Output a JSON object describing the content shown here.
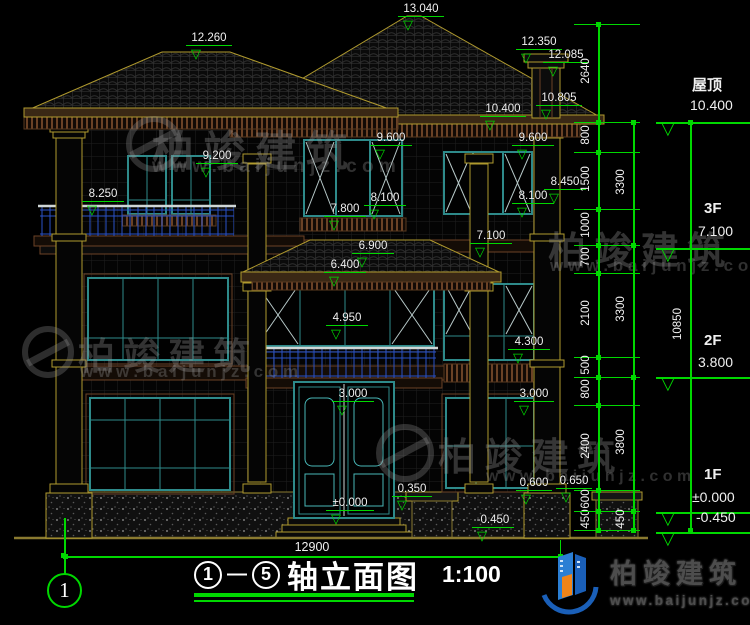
{
  "scene": {
    "background": "#000000",
    "annotation_green": "#00d800",
    "text_white": "#f0f0f0"
  },
  "icons": {
    "level_triangle": "▽"
  },
  "title_block": {
    "from": "1",
    "to": "5",
    "dash": "—",
    "title": "轴立面图",
    "scale": "1:100"
  },
  "axis_bubble": {
    "label": "1"
  },
  "bottom_dim": {
    "label": "12900",
    "x1": 65,
    "x2": 560,
    "y": 556
  },
  "watermark": {
    "brand": "柏竣建筑",
    "url": "www.baijunjz.com"
  },
  "logo": {
    "brand": "柏竣建筑",
    "url": "www.baijunjz.com"
  },
  "elevation_markers": [
    {
      "label": "12.260",
      "x": 186,
      "y": 46,
      "w": 46
    },
    {
      "label": "13.040",
      "x": 398,
      "y": 17,
      "w": 46
    },
    {
      "label": "12.350",
      "x": 516,
      "y": 50,
      "w": 46
    },
    {
      "label": "12.085",
      "x": 543,
      "y": 63,
      "w": 46
    },
    {
      "label": "10.805",
      "x": 536,
      "y": 106,
      "w": 46
    },
    {
      "label": "10.400",
      "x": 480,
      "y": 117,
      "w": 46
    },
    {
      "label": "9.600",
      "x": 370,
      "y": 146,
      "w": 42
    },
    {
      "label": "9.600",
      "x": 512,
      "y": 146,
      "w": 42
    },
    {
      "label": "9.200",
      "x": 196,
      "y": 164,
      "w": 42
    },
    {
      "label": "8.450",
      "x": 544,
      "y": 190,
      "w": 42
    },
    {
      "label": "8.250",
      "x": 82,
      "y": 202,
      "w": 42
    },
    {
      "label": "8.100",
      "x": 364,
      "y": 206,
      "w": 42
    },
    {
      "label": "8.100",
      "x": 512,
      "y": 204,
      "w": 42
    },
    {
      "label": "7.800",
      "x": 324,
      "y": 217,
      "w": 42
    },
    {
      "label": "7.100",
      "x": 470,
      "y": 244,
      "w": 42
    },
    {
      "label": "6.900",
      "x": 352,
      "y": 254,
      "w": 42
    },
    {
      "label": "6.400",
      "x": 324,
      "y": 273,
      "w": 42
    },
    {
      "label": "4.950",
      "x": 326,
      "y": 326,
      "w": 42
    },
    {
      "label": "4.300",
      "x": 508,
      "y": 350,
      "w": 42
    },
    {
      "label": "3.000",
      "x": 332,
      "y": 402,
      "w": 42
    },
    {
      "label": "3.000",
      "x": 514,
      "y": 402,
      "w": 40
    },
    {
      "label": "0.350",
      "x": 392,
      "y": 497,
      "w": 40
    },
    {
      "label": "0.600",
      "x": 516,
      "y": 491,
      "w": 36
    },
    {
      "label": "0.650",
      "x": 556,
      "y": 489,
      "w": 36
    },
    {
      "label": "±0.000",
      "x": 326,
      "y": 511,
      "w": 48
    },
    {
      "label": "-0.450",
      "x": 472,
      "y": 528,
      "w": 42
    }
  ],
  "levels": [
    {
      "name": "屋顶",
      "elev": "10.400",
      "nx": 692,
      "ny": 74,
      "ex": 690,
      "ey": 97,
      "ly": 122
    },
    {
      "name": "3F",
      "elev": "7.100",
      "nx": 704,
      "ny": 200,
      "ex": 698,
      "ey": 223,
      "ly": 248
    },
    {
      "name": "2F",
      "elev": "3.800",
      "nx": 704,
      "ny": 332,
      "ex": 698,
      "ey": 354,
      "ly": 377
    },
    {
      "name": "1F",
      "elev": "±0.000",
      "nx": 704,
      "ny": 466,
      "ex": 692,
      "ey": 489,
      "ly": 512
    },
    {
      "name": "",
      "elev": "-0.450",
      "nx": 0,
      "ny": 0,
      "ex": 696,
      "ey": 509,
      "ly": 532
    }
  ],
  "dim_chains": [
    {
      "x": 598,
      "segs": [
        [
          "2640",
          24,
          122
        ],
        [
          "800",
          122,
          152
        ],
        [
          "1500",
          152,
          209
        ],
        [
          "1000",
          209,
          245
        ],
        [
          "700",
          245,
          273
        ],
        [
          "2100",
          273,
          357
        ],
        [
          "500",
          357,
          377
        ],
        [
          "800",
          377,
          405
        ],
        [
          "2400",
          405,
          490
        ],
        [
          "600",
          490,
          511
        ],
        [
          "450",
          511,
          530
        ]
      ]
    },
    {
      "x": 633,
      "segs": [
        [
          "3300",
          122,
          245
        ],
        [
          "3300",
          245,
          377
        ],
        [
          "3800",
          377,
          511
        ],
        [
          "450",
          511,
          530
        ]
      ]
    },
    {
      "x": 690,
      "segs": [
        [
          "10850",
          122,
          530
        ]
      ]
    }
  ],
  "watermarks": [
    {
      "ix": 126,
      "iy": 116,
      "is": 56,
      "tx": 152,
      "ty": 118,
      "ts": 42,
      "ux": 152,
      "uy": 156,
      "us": 19
    },
    {
      "ix": 22,
      "iy": 326,
      "is": 52,
      "tx": 78,
      "ty": 326,
      "ts": 37,
      "ux": 80,
      "uy": 362,
      "us": 17
    },
    {
      "ix": 0,
      "iy": 0,
      "is": 0,
      "tx": 548,
      "ty": 220,
      "ts": 38,
      "ux": 550,
      "uy": 256,
      "us": 17
    },
    {
      "ix": 376,
      "iy": 424,
      "is": 58,
      "tx": 438,
      "ty": 426,
      "ts": 38,
      "ux": 486,
      "uy": 468,
      "us": 16
    }
  ]
}
